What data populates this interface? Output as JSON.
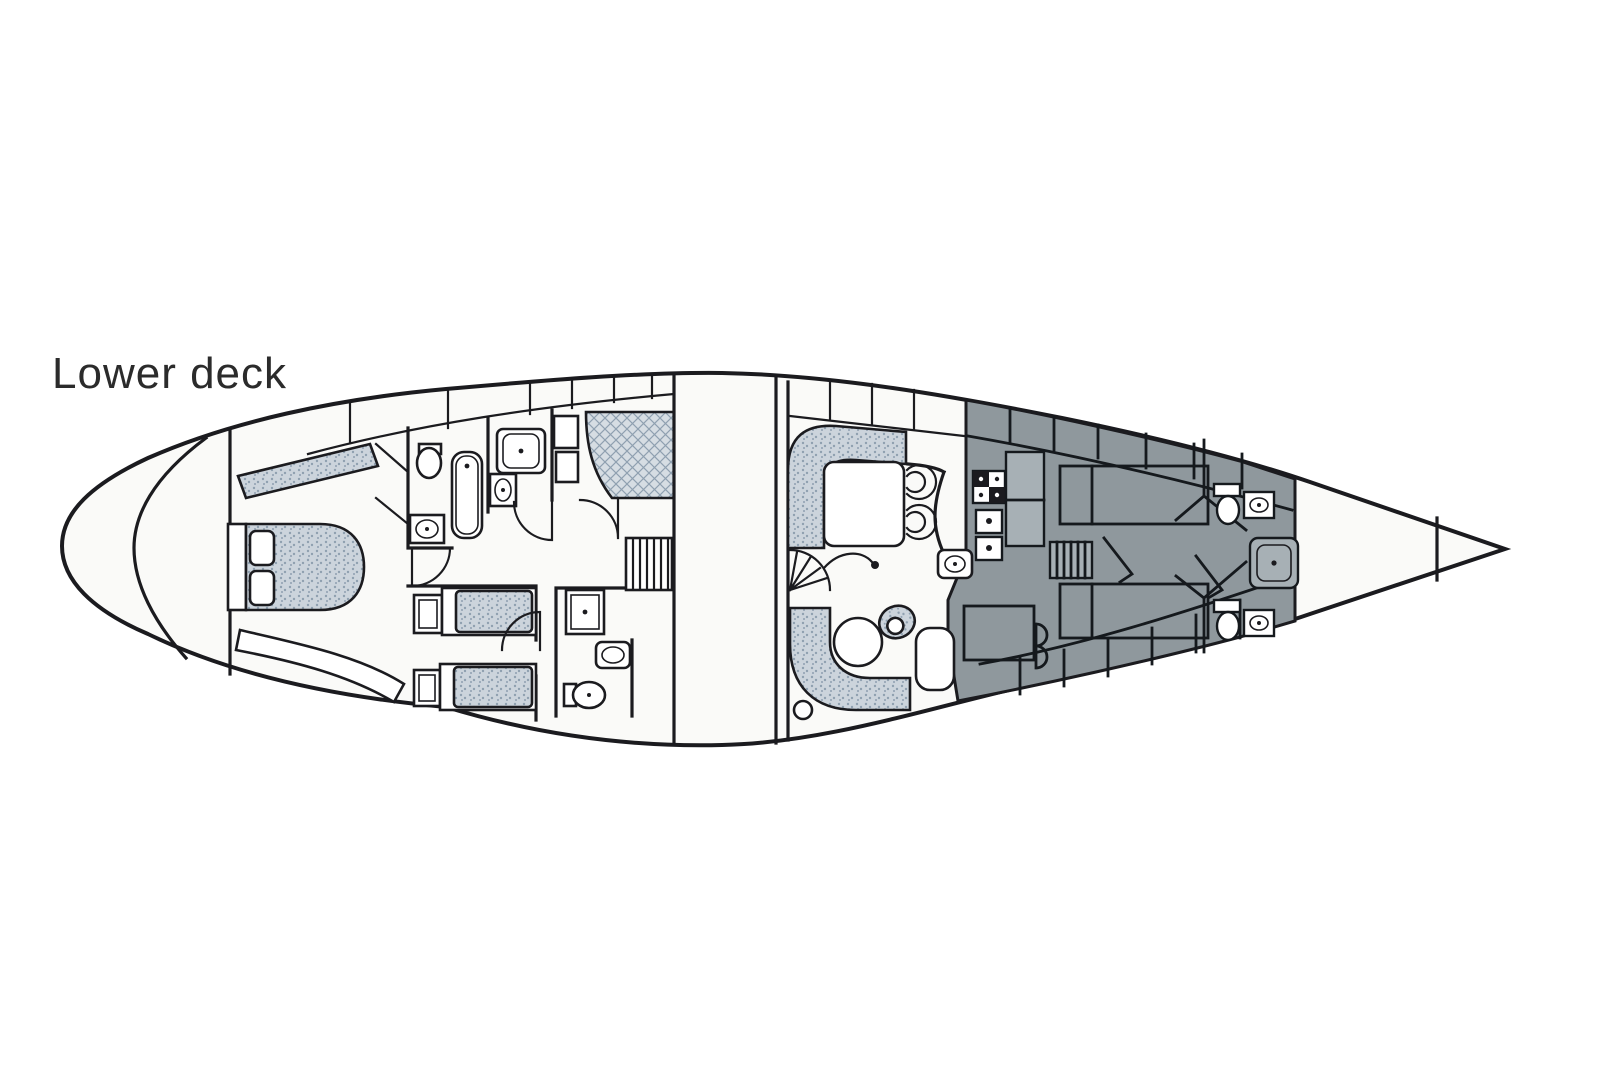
{
  "title": "Lower deck",
  "diagram": {
    "type": "yacht-deck-plan",
    "colors": {
      "background": "#ffffff",
      "hull_fill": "#fafaf8",
      "line": "#1b1b1f",
      "text": "#2b2b2b",
      "upholstery": "#ccd4dc",
      "upholstery_dot": "#8fa0b0",
      "bed_fill": "#d6dde3",
      "dark_area": "#8f989d",
      "dark_area_line": "#15191d",
      "counter": "#a7b0b5"
    }
  }
}
